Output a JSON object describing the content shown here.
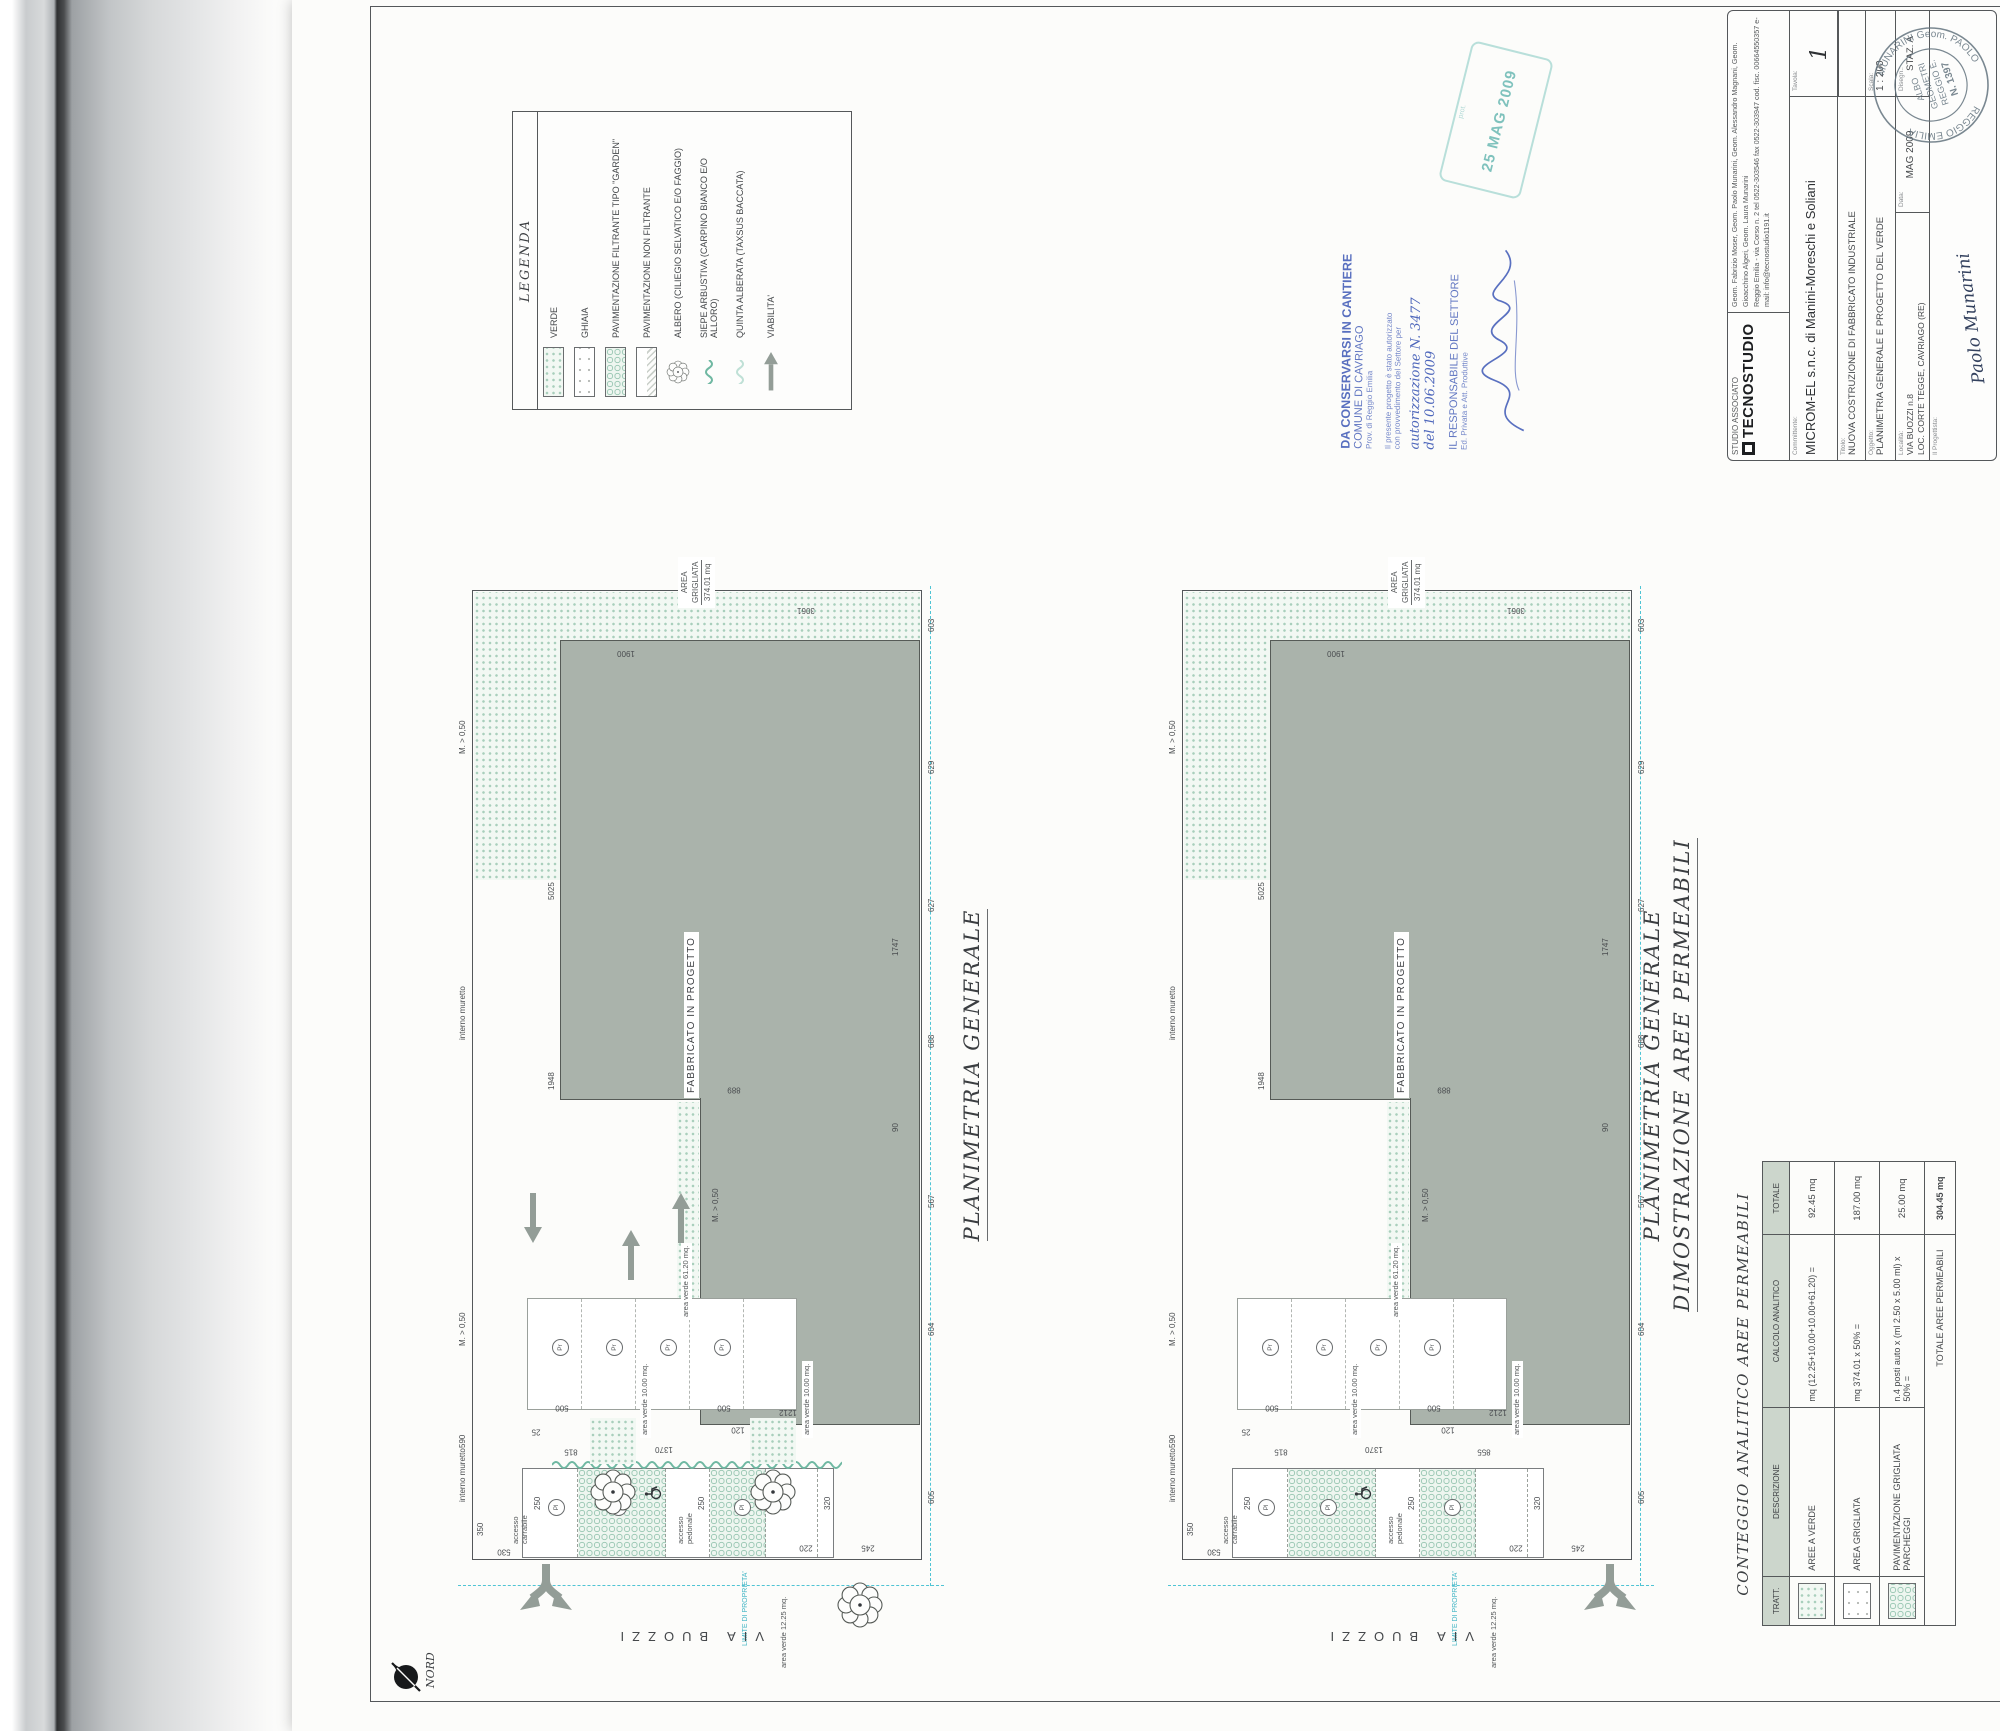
{
  "legend": {
    "title": "LEGENDA",
    "items": [
      {
        "label": "VERDE",
        "swatch": "verde"
      },
      {
        "label": "GHIAIA",
        "swatch": "ghiaia"
      },
      {
        "label": "PAVIMENTAZIONE FILTRANTE TIPO \"GARDEN\"",
        "swatch": "garden"
      },
      {
        "label": "PAVIMENTAZIONE NON FILTRANTE",
        "swatch": "nonfiltrante"
      },
      {
        "label": "ALBERO (CILIEGIO SELVATICO E/O FAGGIO)",
        "swatch": "tree"
      },
      {
        "label": "SIEPE ARBUSTIVA (CARPINO BIANCO E/O ALLORO)",
        "swatch": "hedge"
      },
      {
        "label": "QUINTA ALBERATA (TAXSUS BACCATA)",
        "swatch": "quinta"
      },
      {
        "label": "VIABILITA'",
        "swatch": "arrow"
      }
    ]
  },
  "plans": {
    "plan1_title": "PLANIMETRIA GENERALE",
    "plan2_title_line1": "PLANIMETRIA GENERALE",
    "plan2_title_line2": "DIMOSTRAZIONE AREE PERMEABILI",
    "building_label": "FABBRICATO IN PROGETTO",
    "street": "VIA BUOZZI",
    "property_limit": "LIMITE DI PROPRIETA'",
    "area_grigliata_label": "AREA GRIGLIATA",
    "area_grigliata_value": "374.01 mq",
    "labels": {
      "interno_muretto": "interno muretto",
      "m_050": "M. > 0,50",
      "area_verde_10": "area verde 10.00 mq.",
      "area_verde_1225": "area verde 12.25 mq.",
      "area_verde_6120": "area verde 61.20 mq.",
      "accesso_carrabile": "accesso carrabile",
      "accesso_pedonale": "accesso pedonale",
      "pr": "Pr",
      "pl": "Pl"
    },
    "dims": [
      {
        "t": "590",
        "x": 112,
        "y": -13,
        "v": 0
      },
      {
        "t": "530",
        "x": 2,
        "y": 28,
        "v": 1
      },
      {
        "t": "350",
        "x": 24,
        "y": 5,
        "v": 0
      },
      {
        "t": "815",
        "x": 102,
        "y": 95,
        "v": 1
      },
      {
        "t": "1370",
        "x": 102,
        "y": 188,
        "v": 1
      },
      {
        "t": "855",
        "x": 102,
        "y": 298,
        "v": 1
      },
      {
        "t": "25",
        "x": 124,
        "y": 60,
        "v": 1
      },
      {
        "t": "120",
        "x": 124,
        "y": 262,
        "v": 1
      },
      {
        "t": "500",
        "x": 146,
        "y": 86,
        "v": 1
      },
      {
        "t": "500",
        "x": 146,
        "y": 248,
        "v": 1
      },
      {
        "t": "250",
        "x": 50,
        "y": 62,
        "v": 0
      },
      {
        "t": "250",
        "x": 50,
        "y": 226,
        "v": 0
      },
      {
        "t": "320",
        "x": 50,
        "y": 352,
        "v": 0
      },
      {
        "t": "220",
        "x": 6,
        "y": 330,
        "v": 1
      },
      {
        "t": "245",
        "x": 6,
        "y": 392,
        "v": 1
      },
      {
        "t": "1212",
        "x": 139,
        "y": 312,
        "v": 1
      },
      {
        "t": "1948",
        "x": 470,
        "y": 76,
        "v": 0
      },
      {
        "t": "5025",
        "x": 660,
        "y": 76,
        "v": 0
      },
      {
        "t": "1900",
        "x": 898,
        "y": 150,
        "v": 1
      },
      {
        "t": "3061",
        "x": 941,
        "y": 330,
        "v": 1
      },
      {
        "t": "889",
        "x": 464,
        "y": 258,
        "v": 1
      },
      {
        "t": "90",
        "x": 428,
        "y": 420,
        "v": 0
      },
      {
        "t": "1747",
        "x": 604,
        "y": 420,
        "v": 0
      },
      {
        "t": "605",
        "x": 56,
        "y": 456,
        "v": 0
      },
      {
        "t": "604",
        "x": 224,
        "y": 456,
        "v": 0
      },
      {
        "t": "567",
        "x": 352,
        "y": 456,
        "v": 0
      },
      {
        "t": "688",
        "x": 512,
        "y": 456,
        "v": 0
      },
      {
        "t": "627",
        "x": 648,
        "y": 456,
        "v": 0
      },
      {
        "t": "629",
        "x": 786,
        "y": 456,
        "v": 0
      },
      {
        "t": "603",
        "x": 928,
        "y": 456,
        "v": 0
      },
      {
        "t": "M. > 0,50",
        "x": 214,
        "y": -13,
        "v": 0
      },
      {
        "t": "M. > 0,50",
        "x": 806,
        "y": -13,
        "v": 0
      },
      {
        "t": "M. > 0,50",
        "x": 338,
        "y": 240,
        "v": 0
      },
      {
        "t": "interno muretto",
        "x": 58,
        "y": -13,
        "v": 0
      },
      {
        "t": "interno muretto",
        "x": 520,
        "y": -13,
        "v": 0
      }
    ],
    "trees_plan1": [
      {
        "x": 68,
        "y": 141
      },
      {
        "x": 68,
        "y": 301
      },
      {
        "x": -45,
        "y": 388
      }
    ],
    "arrows_plan1": [
      {
        "x": 317,
        "y": 52,
        "d": 180
      },
      {
        "x": 315,
        "y": 200,
        "d": 0
      },
      {
        "x": 278,
        "y": 150,
        "d": 0
      }
    ],
    "pr_circles": [
      {
        "x": 204,
        "y": 80
      },
      {
        "x": 204,
        "y": 134
      },
      {
        "x": 204,
        "y": 188
      },
      {
        "x": 204,
        "y": 242
      }
    ],
    "pl_circles": [
      {
        "x": 44,
        "y": 76
      },
      {
        "x": 44,
        "y": 138
      },
      {
        "x": 44,
        "y": 262
      }
    ]
  },
  "table": {
    "title": "CONTEGGIO ANALITICO AREE PERMEABILI",
    "headers": [
      "TRATT.",
      "DESCRIZIONE",
      "CALCOLO ANALITICO",
      "TOTALE"
    ],
    "rows": [
      {
        "desc": "AREE A VERDE",
        "calc": "mq (12.25+10.00+10.00+61.20) =",
        "tot": "92.45 mq"
      },
      {
        "desc": "AREA GRIGLIATA",
        "calc": "mq 374.01 x 50% =",
        "tot": "187.00 mq"
      },
      {
        "desc": "PAVIMENTAZIONE GRIGLIATA PARCHEGGI",
        "calc": "n.4 posti auto x (ml 2.50 x 5.00 ml) x 50% =",
        "tot": "25.00 mq"
      }
    ],
    "footer_label": "TOTALE AREE PERMEABILI",
    "footer_total": "304.45 mq"
  },
  "title_block": {
    "studio_small": "STUDIO ASSOCIATO",
    "studio_logo": "TECNOSTUDIO",
    "studio_names": "Geom. Fabrizio Moser, Geom. Paolo Munarini, Geom. Alessandro Magnani, Geom. Gioacchino Algeri, Geom. Laura Munarini",
    "studio_contacts": "Reggio Emilia - via Corso n. 2    tel 0522-303546    fax 0522-303947    cod. fisc. 00664550357    e-mail: info@tecnostudio1191.it",
    "committente_label": "Committente:",
    "committente": "MICROM-EL  s.n.c.  di  Manini-Moreschi  e  Soliani",
    "titolo_label": "Titolo:",
    "titolo": "NUOVA COSTRUZIONE DI FABBRICATO INDUSTRIALE",
    "oggetto_label": "Oggetto:",
    "oggetto": "PLANIMETRIA GENERALE E PROGETTO DEL VERDE",
    "localita_label": "Località:",
    "localita_line1": "VIA BUOZZI n.8",
    "localita_line2": "LOC. CORTE TEGGE, CAVRIAGO (RE)",
    "scala_label": "Scala:",
    "scala": "1 : 200",
    "data_label": "Data:",
    "data": "MAG 2009",
    "disegn_label": "Disegn.:",
    "disegn": "STAZ. A",
    "tavola_label": "Tavola:",
    "tavola": "1",
    "progettista_label": "Il Progettista:",
    "progettista_sig": "Paolo Munarini",
    "seal": {
      "arc_top": "MUNARINI Geom. PAOLO",
      "arc_bottom": "REGGIO EMILIA",
      "c1": "ALBO",
      "c2": "GEOMETRI",
      "c3": "REGGIO E.",
      "c4": "N. 1397"
    }
  },
  "stamps": {
    "blue": {
      "l1": "DA CONSERVARSI IN CANTIERE",
      "l2": "COMUNE DI CAVRIAGO",
      "l3": "Prov. di Reggio Emilia",
      "l4": "Il presente progetto è stato autorizzato",
      "l5": "con provvedimento del Settore per",
      "l6": "autorizzazione N. 3477",
      "l7": "del  10.06.2009",
      "l8": "IL RESPONSABILE DEL SETTORE",
      "l9": "Ed. Privata e Att. Produttive"
    },
    "teal": {
      "date": "25 MAG 2009",
      "prot": "prot."
    }
  },
  "north_label": "NORD"
}
